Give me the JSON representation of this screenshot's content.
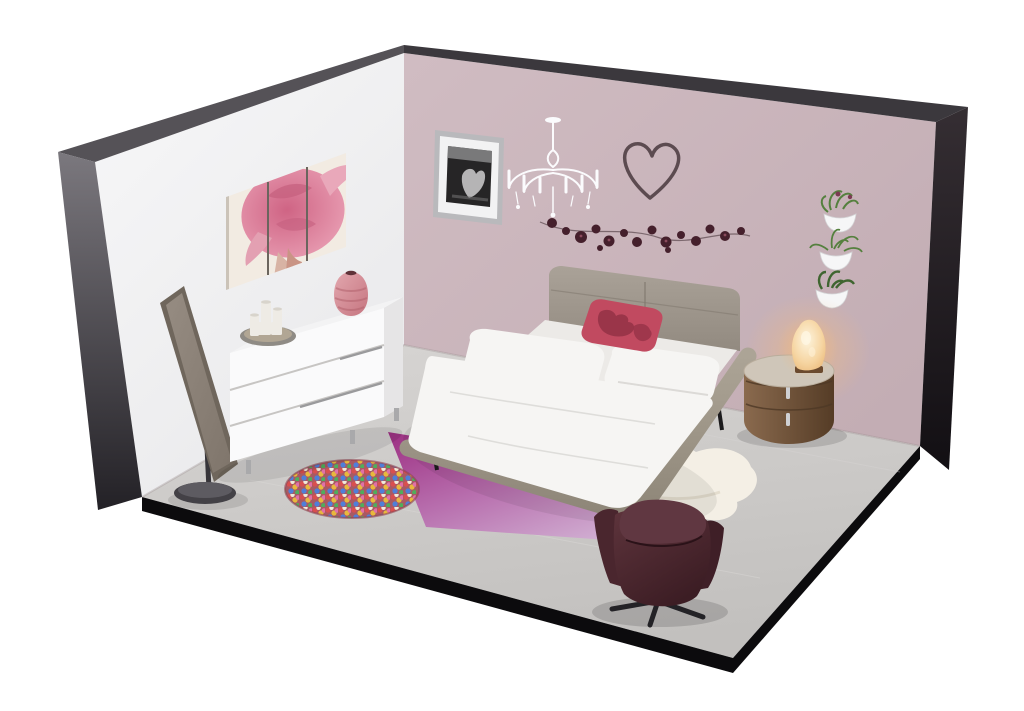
{
  "meta": {
    "content_type": "3d-isometric-room-render",
    "room": "bedroom cutaway diorama, two walls and floor, viewed from above-front",
    "canvas": {
      "width": 1024,
      "height": 711
    }
  },
  "scene": {
    "objects": [
      "left-wall-white",
      "right-wall-mauve",
      "gray-carpet-floor",
      "black-wall-edges",
      "triptych-painting-pink-hair-woman",
      "cheval-standing-mirror",
      "white-three-drawer-dresser",
      "pillar-candle-tray",
      "pink-striped-vase",
      "framed-black-white-photo",
      "white-crystal-chandelier",
      "wire-heart-wall-decor",
      "dark-flower-garland",
      "three-white-wall-planters",
      "gray-upholstered-platform-bed",
      "white-bedding-and-pillows",
      "red-damask-accent-pillow",
      "purple-ombre-area-rug",
      "multicolor-pompom-round-rug",
      "white-sheepskin-rug",
      "oval-walnut-nightstand",
      "glowing-salt-lamp",
      "burgundy-swivel-armchair"
    ]
  },
  "palette": {
    "page_bg": "#ffffff",
    "left_wall_top": "#f7f7f8",
    "left_wall_bottom": "#e9e9eb",
    "right_wall_light": "#d0bcc2",
    "right_wall_deep": "#c3adb4",
    "edge_top_left": "#555257",
    "edge_top_right": "#3b383d",
    "edge_left_light": "#7b787e",
    "edge_left_dark": "#232126",
    "edge_right_light": "#352e33",
    "edge_right_dark": "#120f13",
    "floor_back": "#d6d4d2",
    "floor_front": "#c2c0be",
    "floor_edge": "#0c0b0d",
    "floor_seam": "#dad8d6",
    "triptych_bg": "#f2ebe2",
    "hair_light": "#e79ab0",
    "hair_deep": "#cf6484",
    "skin": "#d8b3a4",
    "panel_gap": "#6b655e",
    "photo_frame": "#b9b9bc",
    "photo_mat": "#f2f2f3",
    "photo_dark": "#262526",
    "photo_light": "#8f8e90",
    "chandelier": "#fbfbfd",
    "heart_wire": "#5c4b50",
    "garland_flower": "#45202c",
    "garland_center": "#8a4a5c",
    "garland_string": "#6e5a60",
    "planter": "#f6f6f7",
    "plant": "#55803e",
    "plant_dark": "#3f6530",
    "plant_flower": "#7b3b52",
    "mirror_frame": "#6f665c",
    "mirror_glass_light": "#968c82",
    "mirror_glass_dark": "#7f756b",
    "mirror_base": "#434146",
    "mirror_base_top": "#5d5b61",
    "mirror_pole": "#37353a",
    "dresser_face": "#fafafb",
    "dresser_side": "#e6e5e6",
    "dresser_top": "#f3f3f4",
    "dresser_seam": "#c7c5c3",
    "dresser_leg": "#a9a9ab",
    "tray": "#8f8b85",
    "tray_inner": "#b1a694",
    "candle": "#eeebe5",
    "candle_shade": "#d8d4cc",
    "vase_light": "#e2a7ae",
    "vase_dark": "#c67580",
    "vase_stripe": "#b3636e",
    "vase_mouth": "#5f3238",
    "headboard_light": "#aaa298",
    "headboard_dark": "#928a80",
    "headboard_seam": "#837b71",
    "bed_frame_light": "#aca496",
    "bed_frame_dark": "#8e8678",
    "bedding": "#f6f5f3",
    "bedding_mid": "#eceae7",
    "bedding_shadow": "#dcdad7",
    "pillow_red": "#c14a60",
    "pillow_red_dark": "#902f44",
    "rug_deep": "#9c2f82",
    "rug_mid": "#b86fae",
    "rug_light": "#d2b2d4",
    "pom_base": "#a85a63",
    "pom_rim": "#8f4552",
    "pom_1": "#d94f4f",
    "pom_2": "#e8b93c",
    "pom_3": "#4f7fd9",
    "pom_4": "#4fae5c",
    "pom_5": "#e070a8",
    "pom_6": "#f0ead9",
    "sheepskin": "#f4efe5",
    "sheepskin_shadow": "#ddd5c4",
    "wood_light": "#8a6a4e",
    "wood_dark": "#553c26",
    "nightstand_top": "#cfc6b9",
    "handle_silver": "#cfd0d3",
    "wood_seam": "#4e3826",
    "lamp_core": "#fdf4dd",
    "lamp_mid": "#f6d5a2",
    "lamp_edge": "#eab878",
    "lamp_base": "#6b4a2e",
    "glow_warm": "#f6bb7a",
    "chair_light": "#5e343c",
    "chair_dark": "#3c1d24",
    "chair_head": "#603741",
    "chair_arm_left": "#4a262e",
    "chair_arm_right": "#3f1f27",
    "chair_base": "#232226",
    "chair_seam": "#2a1218",
    "leg_black": "#1b1a1c"
  }
}
